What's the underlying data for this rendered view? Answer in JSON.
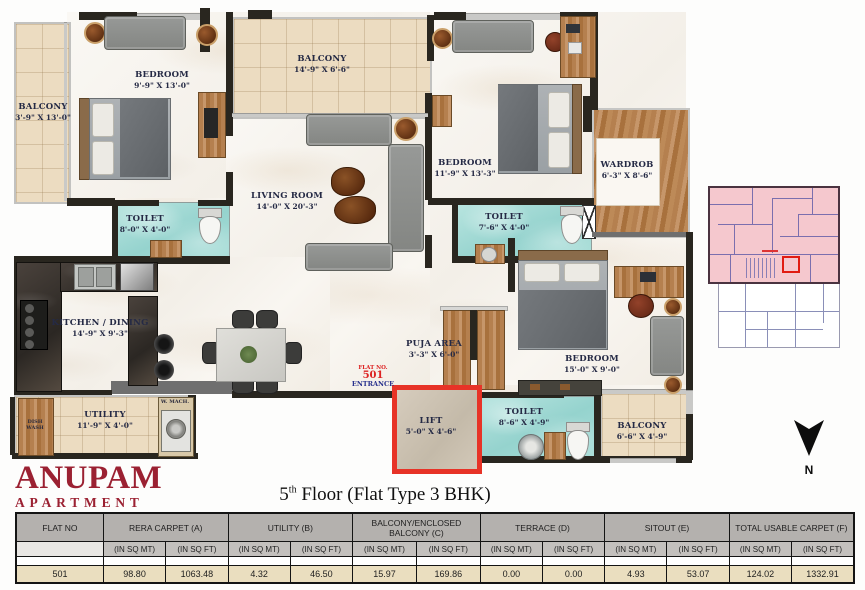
{
  "branding": {
    "line1": "ANUPAM",
    "line2": "APARTMENT"
  },
  "floor_title": {
    "num": "5",
    "sup": "th",
    "rest": " Floor (Flat Type 3 BHK)"
  },
  "compass": {
    "label": "N"
  },
  "plan": {
    "rooms": [
      {
        "name": "BALCONY",
        "dims": "3'-9\" X 13'-0\""
      },
      {
        "name": "BEDROOM",
        "dims": "9'-9\" X 13'-0\""
      },
      {
        "name": "BALCONY",
        "dims": "14'-9\" X 6'-6\""
      },
      {
        "name": "LIVING ROOM",
        "dims": "14'-0\" X 20'-3\""
      },
      {
        "name": "BEDROOM",
        "dims": "11'-9\" X 13'-3\""
      },
      {
        "name": "WARDROB",
        "dims": "6'-3\" X 8'-6\""
      },
      {
        "name": "TOILET",
        "dims": "8'-0\" X 4'-0\""
      },
      {
        "name": "TOILET",
        "dims": "7'-6\" X 4'-0\""
      },
      {
        "name": "KITCHEN / DINING",
        "dims": "14'-9\" X 9'-3\""
      },
      {
        "name": "UTILITY",
        "dims": "11'-9\" X 4'-0\""
      },
      {
        "name": "PUJA AREA",
        "dims": "3'-3\" X 6'-0\""
      },
      {
        "name": "LIFT",
        "dims": "5'-0\" X 4'-6\""
      },
      {
        "name": "TOILET",
        "dims": "8'-6\" X 4'-9\""
      },
      {
        "name": "BEDROOM",
        "dims": "15'-0\" X 9'-0\""
      },
      {
        "name": "BALCONY",
        "dims": "6'-6\" X 4'-9\""
      }
    ],
    "entrance": {
      "flat_no_label": "FLAT NO.",
      "flat_no": "501",
      "entrance_label": "ENTRANCE"
    },
    "appliances": {
      "dish_wash": "DISH WASH",
      "washing_machine": "W. MACH."
    }
  },
  "table": {
    "headers": [
      "FLAT NO",
      "RERA CARPET (A)",
      "UTILITY (B)",
      "BALCONY/ENCLOSED BALCONY (C)",
      "TERRACE (D)",
      "SITOUT (E)",
      "TOTAL USABLE CARPET (F)"
    ],
    "unit_mt": "(IN SQ MT)",
    "unit_ft": "(IN SQ FT)",
    "row": [
      "501",
      "98.80",
      "1063.48",
      "4.32",
      "46.50",
      "15.97",
      "169.86",
      "0.00",
      "0.00",
      "4.93",
      "53.07",
      "124.02",
      "1332.91"
    ]
  },
  "colors": {
    "accent_red": "#e73327",
    "logo_maroon": "#9b2132",
    "toilet_teal": "#a6dcd7",
    "balcony_beige": "#ecdcc1",
    "wood": "#b5804f",
    "keyplan_pink": "#f5c8ce"
  }
}
